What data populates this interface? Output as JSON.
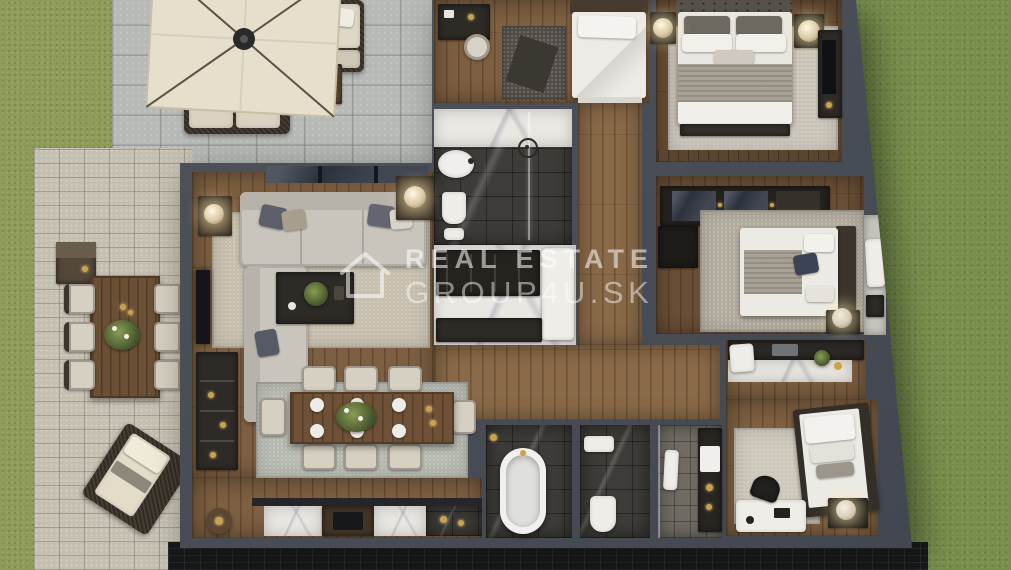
{
  "scene": {
    "type": "3d-floor-plan-render",
    "subject": "top-down 3D rendering of a furnished apartment with outdoor patio, lawn, living-dining area, three bedrooms and bathrooms"
  },
  "watermark": {
    "brand_line1": "REAL ESTATE",
    "brand_line2": "GROUP4U.SK",
    "logo_icon": "house-outline-icon",
    "text_color": "#FFFFFF",
    "opacity": 0.55
  },
  "palette": {
    "grass": "#788E4C",
    "grass_light": "#8D9B58",
    "stone_patio": "#B6B9B5",
    "paver_patio": "#C5BFB1",
    "wall": "#4A4F57",
    "wood_floor": "#7D5F41",
    "rug_beige": "#C9C3B8",
    "rug_bluegray": "#B7BAB1",
    "sofa_gray": "#C9C5BD",
    "bedding_white": "#ECEAE5",
    "marble_light": "#E9E7E2",
    "marble_dark": "#3D3C38",
    "umbrella_cream": "#E6DFCC",
    "accent_navy": "#3D4357",
    "accent_gold": "#C9A24F",
    "facade_dark": "#17181B"
  }
}
